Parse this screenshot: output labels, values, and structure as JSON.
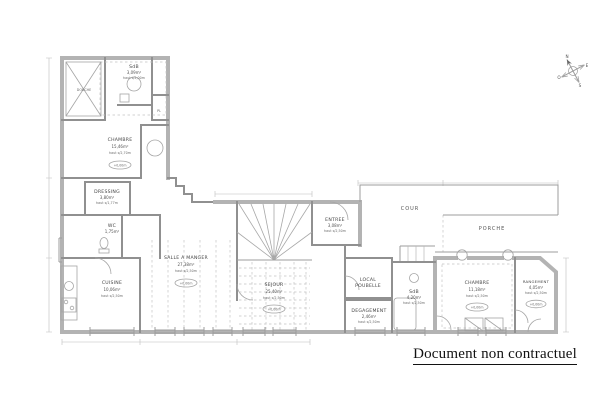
{
  "footer": {
    "disclaimer": "Document non contractuel"
  },
  "compass": {
    "n": "N",
    "e": "E",
    "s": "S",
    "o": "O"
  },
  "rooms": {
    "douche": {
      "name": "DOUCHE"
    },
    "sdb1": {
      "name": "SdB",
      "area": "3,09m²",
      "height": "haut s/2,00m"
    },
    "pl": {
      "name": "PL"
    },
    "chambre1": {
      "name": "CHAMBRE",
      "area": "15,46m²",
      "height": "haut s/2,70m",
      "level": "+0,00m"
    },
    "dressing": {
      "name": "DRESSING",
      "area": "3,80m²",
      "height": "haut s/1,77m"
    },
    "wc": {
      "name": "WC",
      "area": "1,75m²"
    },
    "cuisine": {
      "name": "CUISINE",
      "area": "10,06m²",
      "height": "haut s/2,50m"
    },
    "salle_a_manger": {
      "name": "SALLE A MANGER",
      "area": "27,38m²",
      "height": "haut s/2,50m",
      "level": "+0,00m"
    },
    "sejour": {
      "name": "SEJOUR",
      "area": "25,40m²",
      "height": "haut s/2,50m",
      "level": "+0,00m"
    },
    "entree": {
      "name": "ENTREE",
      "area": "3,08m²",
      "height": "haut s/2,50m"
    },
    "cour": {
      "name": "COUR"
    },
    "porche": {
      "name": "PORCHE"
    },
    "local_poubelle": {
      "name": "LOCAL",
      "name2": "POUBELLE"
    },
    "degagement": {
      "name": "DEGAGEMENT",
      "area": "2,46m²",
      "height": "haut s/2,50m"
    },
    "sdb2": {
      "name": "SdB",
      "area": "4,20m²",
      "height": "haut s/2,50m"
    },
    "chambre2": {
      "name": "CHAMBRE",
      "area": "11,18m²",
      "height": "haut s/2,50m",
      "level": "+0,00m"
    },
    "rangement": {
      "name": "RANGEMENT",
      "area": "4,05m²",
      "height": "haut s/2,50m",
      "level": "+0,00m"
    }
  }
}
